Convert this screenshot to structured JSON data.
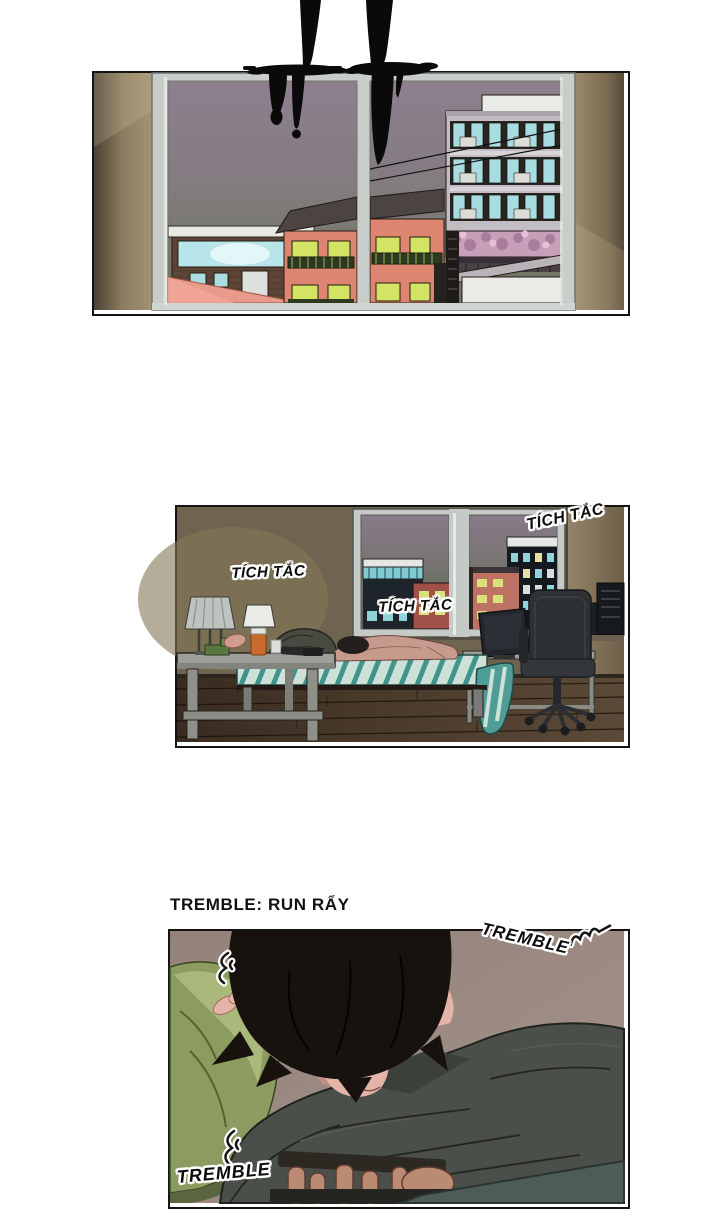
{
  "page": {
    "kind": "webtoon-comic-page",
    "background": "#ffffff"
  },
  "translation_note": {
    "text": "TREMBLE: RUN RẨY"
  },
  "panels": {
    "panel1": {
      "name": "window-city-view",
      "description": "Black ink drips from above over a window looking out on dusk apartment buildings and houses"
    },
    "panel2": {
      "name": "bedroom-night",
      "description": "Figure lying face-down on a striped bed in a dim room with desk, lamps and office chair",
      "sfx_left": "TÍCH TẮC",
      "sfx_center": "TÍCH TẮC",
      "sfx_top_right": "TÍCH TẮC"
    },
    "panel3": {
      "name": "trembling-closeup",
      "description": "Close-up of the figure trembling face-down against a green pillow",
      "sfx_top_right": "TREMBLE",
      "sfx_bottom_left": "TREMBLE"
    }
  },
  "colors": {
    "ink": "#0a0a0a",
    "panel_border": "#141414",
    "sky_dusk": "#8e7f8e",
    "wall_tan": "#97876c",
    "wall_olive": "#6f6450",
    "wall_taupe": "#9c8a82",
    "window_frame": "#c9cdc9",
    "lit_window_yellow": "#d3e464",
    "lit_window_cyan": "#aadde2",
    "house_salmon": "#dd8570",
    "blanket_teal": "#4f9d97",
    "pillow_green": "#8c9c60",
    "jacket_gray": "#4b4f49",
    "skin": "#e3b2a6"
  }
}
